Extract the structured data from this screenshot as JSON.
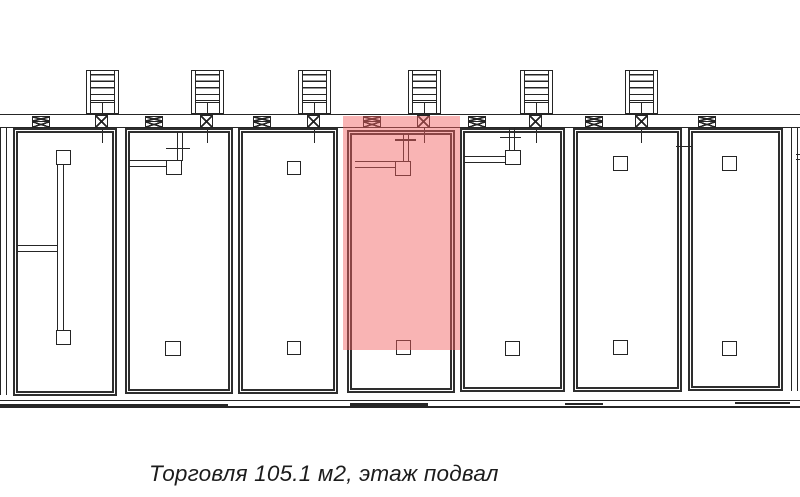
{
  "caption": {
    "text": "Торговля 105.1 м2, этаж подвал",
    "usage_type": "Торговля",
    "area": "105.1 м2",
    "floor": "этаж подвал"
  },
  "highlight": {
    "fill_color": "rgba(242,95,95,0.47)",
    "rendered_tint": "#f8b4b4",
    "meaning": "selected retail unit on plan"
  },
  "plan": {
    "line_color": "#262626",
    "background": "#ffffff",
    "staircase_count": 6,
    "visible_unit_count": 8,
    "highlighted_unit_index": 5
  }
}
